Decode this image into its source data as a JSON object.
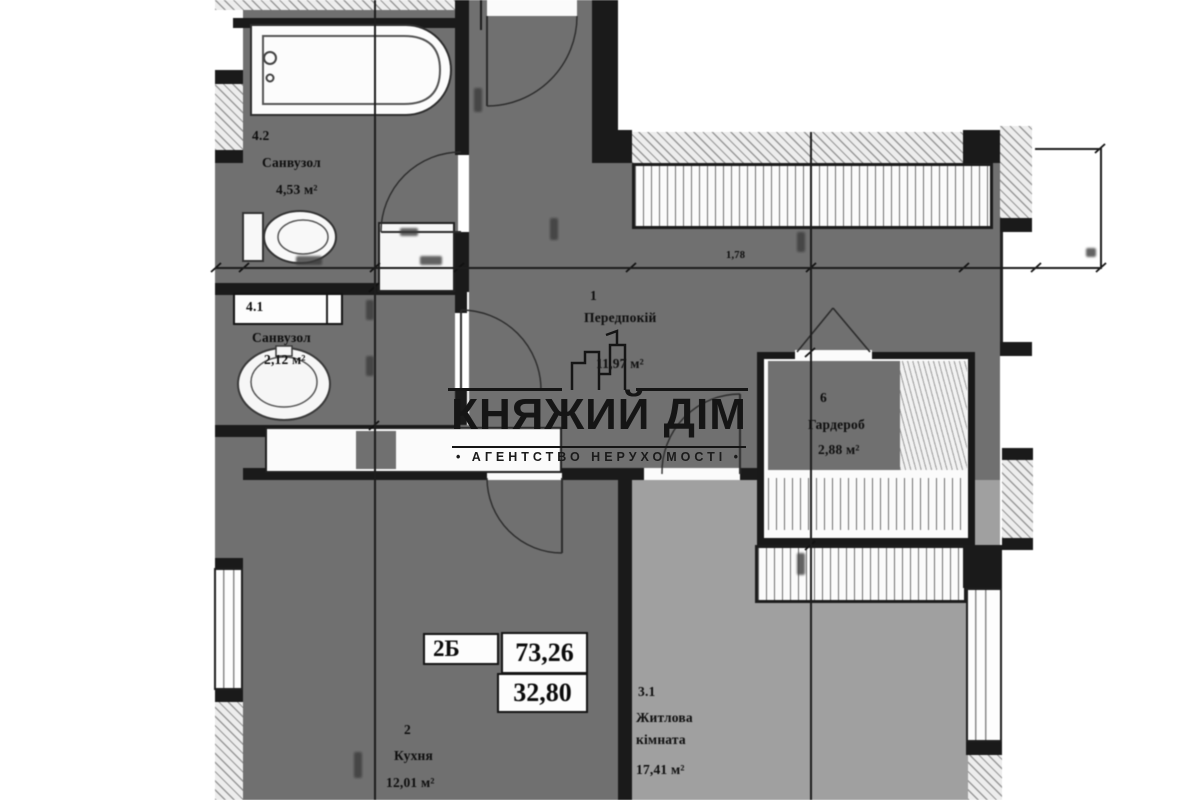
{
  "plan": {
    "rooms": [
      {
        "number": "4.2",
        "name": "Санвузол",
        "area": "4,53 м²"
      },
      {
        "number": "4.1",
        "name": "Санвузол",
        "area": "2,12 м²"
      },
      {
        "number": "1",
        "name": "Передпокій",
        "area": "11,97 м²"
      },
      {
        "number": "6",
        "name": "Гардероб",
        "area": "2,88 м²"
      },
      {
        "number": "2",
        "name": "Кухня",
        "area": "12,01 м²"
      },
      {
        "number": "3.1",
        "name_line1": "Житлова",
        "name_line2": "кімната",
        "area": "17,41 м²"
      }
    ],
    "stamp": {
      "unit_type": "2Б",
      "total_area": "73,26",
      "living_area": "32,80"
    },
    "dimension_labels": {
      "corridor_width": "1,78"
    }
  },
  "watermark": {
    "brand": "КНЯЖИЙ ДІМ",
    "tagline": "• АГЕНТСТВО НЕРУХОМОСТІ •"
  },
  "colors": {
    "room_dark": "#707070",
    "room_light": "#a0a0a0",
    "wall": "#1a1a1a",
    "watermark": "#151515"
  }
}
